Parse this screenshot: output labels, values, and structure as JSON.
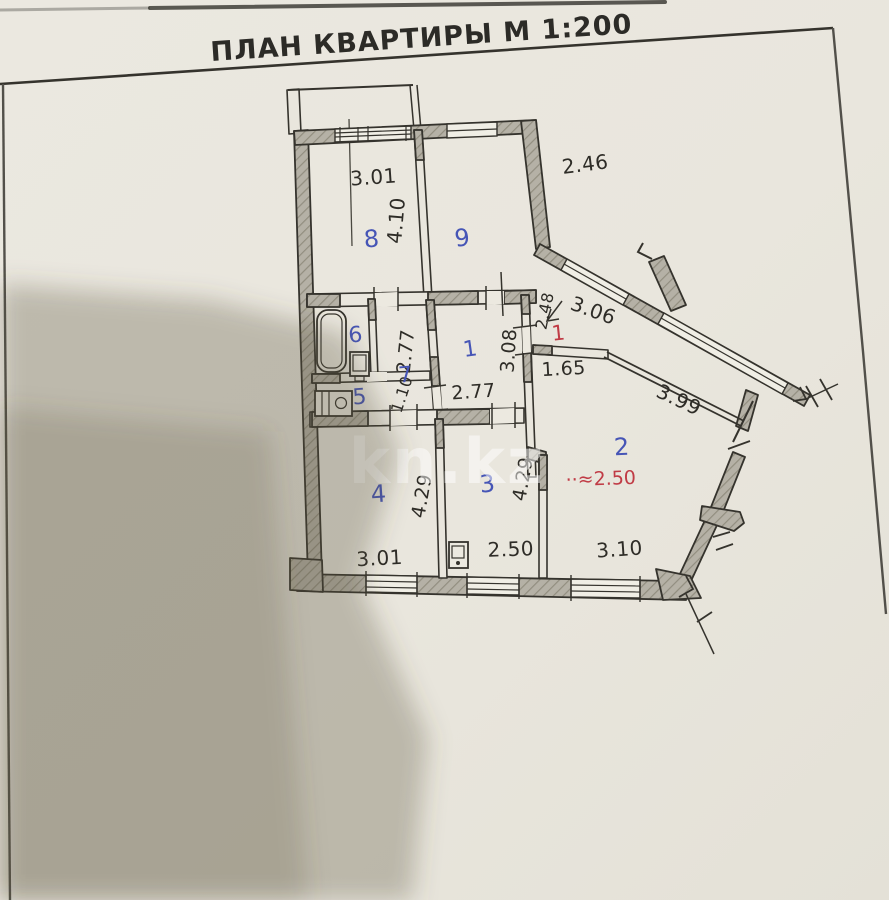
{
  "page": {
    "title": "ПЛАН КВАРТИРЫ  М 1:200",
    "watermark": "kn.kz"
  },
  "colors": {
    "paper": "#e9e6dd",
    "ink": "#35332d",
    "wall_fill": "#b5b1a6",
    "room_number_blue": "#4655b6",
    "red_mark": "#c03b45",
    "photo_shadow": "rgba(86,76,57,0.30)"
  },
  "rooms": {
    "r1": "1",
    "r2": "2",
    "r3": "3",
    "r4": "4",
    "r5": "5",
    "r6": "6",
    "r7": "7",
    "r8": "8",
    "r9": "9"
  },
  "red_marks": {
    "entrance": "1",
    "note": "··≈2.50"
  },
  "dimensions": {
    "room8_width": "3.01",
    "room9_width": "2.46",
    "room8_depth": "4.10",
    "bath_height": "2.77",
    "hall_height": "3.08",
    "hall_width": "2.77",
    "wc_width": "1.10",
    "entry_passage": "2.48",
    "diagonal_wall": "3.06",
    "entry_width": "1.65",
    "loggia_parapet": "3.99",
    "room4_depth": "4.29",
    "room3_depth": "4.29",
    "room4_width": "3.01",
    "room3_width": "2.50",
    "room2_width": "3.10"
  }
}
